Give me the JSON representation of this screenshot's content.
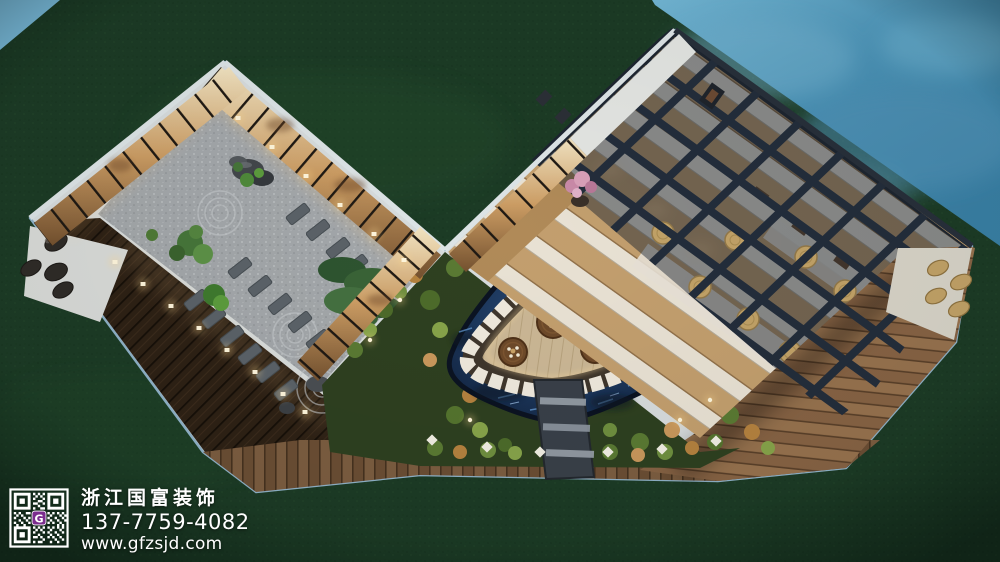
{
  "watermark": {
    "company_name": "浙江国富装饰",
    "phone": "137-7759-4082",
    "website": "www.gfzsjd.com",
    "qr": {
      "center_letter": "G",
      "badge_color": "#7b2d8e",
      "module_color": "#ffffff"
    }
  },
  "scene": {
    "type": "3d-architectural-rendering",
    "view": "aerial night view of a V-shaped tea-house courtyard complex on a lawn beside water",
    "regions": [
      {
        "name": "lawn",
        "label": "dark green lawn surrounding the site"
      },
      {
        "name": "sea-water",
        "label": "blue water across the upper-right edge"
      },
      {
        "name": "pool-corner",
        "label": "light blue pool sliver in the top-left corner"
      },
      {
        "name": "zen-garden-room",
        "label": "glass-walled gravel zen garden with rocks, raked sand circles, pine tree and stepping stones"
      },
      {
        "name": "tea-house-wing",
        "label": "wing with dark glazed roof grid, warm lit wooden interior and round straw mats"
      },
      {
        "name": "courtyard-garden",
        "label": "planted courtyard ring with autumn shrubs and diamond path lights"
      },
      {
        "name": "courtyard-pond",
        "label": "dark blue ornamental pond"
      },
      {
        "name": "sunken-lounge",
        "label": "rounded triangular sunken lounge, white cushion ring, three round tea tables"
      },
      {
        "name": "stone-bridge",
        "label": "stone walkway bridging pond to deck"
      },
      {
        "name": "wood-decks",
        "label": "dark and light timber decks along the outside"
      },
      {
        "name": "patio-mats",
        "label": "oval straw mats on the east patio"
      }
    ],
    "palette": {
      "lawn": "#1c3b25",
      "water": "#4a92b6",
      "pool": "#7fc3e5",
      "wall": "#d7dcdd",
      "glass_glow": "#cb9c63",
      "gravel": "#a3a7aa",
      "deck_dark": "#2e2115",
      "deck_light": "#97724e",
      "pond": "#16294a",
      "cushion": "#efe9dd",
      "roof_grid": "#232d3b",
      "straw_mat": "#c2a267",
      "night_light": "#ffd98f"
    }
  }
}
